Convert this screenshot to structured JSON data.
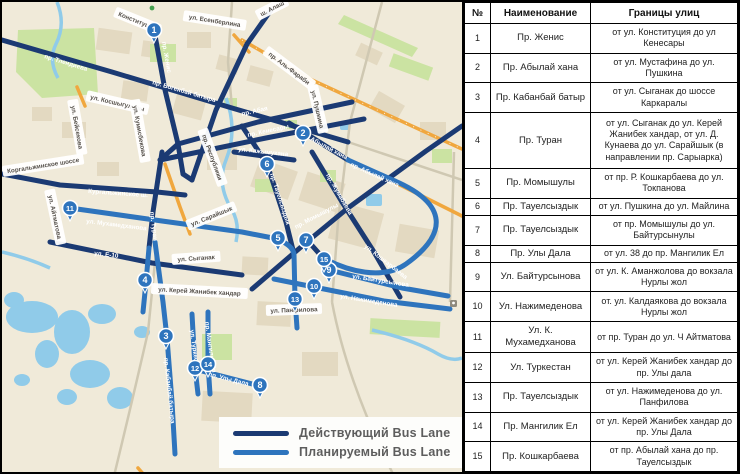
{
  "map": {
    "colors": {
      "existing": "#1b3a73",
      "planned": "#2e74bd",
      "road_orange": "#f0a73e",
      "water": "#90cbe9",
      "green": "#cbe3a2",
      "background": "#f0ead9"
    },
    "legend": {
      "items": [
        {
          "type": "existing",
          "label": "Действующий Bus Lane"
        },
        {
          "type": "planned",
          "label": "Планируемый Bus Lane"
        }
      ]
    },
    "markers": [
      {
        "n": "1",
        "x": 152,
        "y": 28
      },
      {
        "n": "2",
        "x": 301,
        "y": 131
      },
      {
        "n": "3",
        "x": 164,
        "y": 334
      },
      {
        "n": "4",
        "x": 143,
        "y": 278
      },
      {
        "n": "5",
        "x": 276,
        "y": 236
      },
      {
        "n": "6",
        "x": 265,
        "y": 162
      },
      {
        "n": "7",
        "x": 304,
        "y": 238
      },
      {
        "n": "8",
        "x": 258,
        "y": 383
      },
      {
        "n": "9",
        "x": 327,
        "y": 268
      },
      {
        "n": "10",
        "x": 312,
        "y": 284
      },
      {
        "n": "11",
        "x": 68,
        "y": 206
      },
      {
        "n": "12",
        "x": 193,
        "y": 366
      },
      {
        "n": "13",
        "x": 293,
        "y": 297
      },
      {
        "n": "14",
        "x": 206,
        "y": 362
      },
      {
        "n": "15",
        "x": 322,
        "y": 257
      }
    ],
    "line_labels": [
      {
        "t": "пр. Тлендиева",
        "x": 42,
        "y": 56,
        "r": 17
      },
      {
        "t": "пр. Женис",
        "x": 160,
        "y": 40,
        "r": 80
      },
      {
        "t": "пр. Богенбай батыра",
        "x": 150,
        "y": 82,
        "r": 16
      },
      {
        "t": "пр. Абая",
        "x": 240,
        "y": 114,
        "r": -13
      },
      {
        "t": "пр. Кенесары",
        "x": 246,
        "y": 135,
        "r": -12
      },
      {
        "t": "пр. Абылай хана",
        "x": 298,
        "y": 133,
        "r": 28
      },
      {
        "t": "ул. Кажымукана",
        "x": 236,
        "y": 149,
        "r": 6
      },
      {
        "t": "пр. Тауелсыздык",
        "x": 268,
        "y": 172,
        "r": 72
      },
      {
        "t": "пр. Жумабаева",
        "x": 324,
        "y": 173,
        "r": 60
      },
      {
        "t": "пр. Момышулы",
        "x": 294,
        "y": 227,
        "r": -28
      },
      {
        "t": "Кургальжинское ш.",
        "x": 86,
        "y": 191,
        "r": 4
      },
      {
        "t": "ул. Мухамедханова",
        "x": 84,
        "y": 221,
        "r": 7
      },
      {
        "t": "пр. Туран",
        "x": 148,
        "y": 210,
        "r": 83
      },
      {
        "t": "ул. Е-10",
        "x": 92,
        "y": 253,
        "r": 7
      },
      {
        "t": "пр. Абылай хана",
        "x": 348,
        "y": 164,
        "r": 24
      },
      {
        "t": "ул. Кошкарбаева",
        "x": 362,
        "y": 245,
        "r": 38
      },
      {
        "t": "ул. Байтурсынова",
        "x": 350,
        "y": 276,
        "r": 9
      },
      {
        "t": "ул. Нажимеденова",
        "x": 338,
        "y": 296,
        "r": 9
      },
      {
        "t": "пр. Улы Дала",
        "x": 206,
        "y": 374,
        "r": 14
      },
      {
        "t": "ул. Туркестан",
        "x": 188,
        "y": 328,
        "r": 82
      },
      {
        "t": "пр. Мангилик Ел",
        "x": 203,
        "y": 320,
        "r": 82
      },
      {
        "t": "пр. Кабанбай батыра",
        "x": 162,
        "y": 356,
        "r": 84
      }
    ],
    "chip_labels": [
      {
        "t": "Конституции",
        "x": 112,
        "y": 12,
        "r": 22
      },
      {
        "t": "ул. Есенберлина",
        "x": 181,
        "y": 16,
        "r": 9
      },
      {
        "t": "ш. Алаш",
        "x": 256,
        "y": 16,
        "r": -27
      },
      {
        "t": "пр. Аль-Фараби",
        "x": 262,
        "y": 50,
        "r": 37
      },
      {
        "t": "ул. Пушкина",
        "x": 308,
        "y": 84,
        "r": 77
      },
      {
        "t": "ул. Бейсекова",
        "x": 68,
        "y": 98,
        "r": 80
      },
      {
        "t": "ул. Косшыгулулы",
        "x": 84,
        "y": 96,
        "r": 13
      },
      {
        "t": "ул. Кумисбекова",
        "x": 130,
        "y": 98,
        "r": 80
      },
      {
        "t": "пр. Республики",
        "x": 198,
        "y": 128,
        "r": 70
      },
      {
        "t": "Коргальжинское шоссе",
        "x": 1,
        "y": 172,
        "r": -9
      },
      {
        "t": "ул. Айтматова",
        "x": 45,
        "y": 188,
        "r": 78
      },
      {
        "t": "ул. Сарайшык",
        "x": 186,
        "y": 226,
        "r": -22
      },
      {
        "t": "ул. Сыганак",
        "x": 170,
        "y": 260,
        "r": -4
      },
      {
        "t": "ул. Керей Жанибек хандар",
        "x": 149,
        "y": 289,
        "r": 3
      },
      {
        "t": "ул. Панфилова",
        "x": 264,
        "y": 311,
        "r": -2
      }
    ],
    "station_icon": "railway-station-icon"
  },
  "table": {
    "headers": [
      "№",
      "Наименование",
      "Границы улиц"
    ],
    "rows": [
      {
        "num": "1",
        "name": "Пр. Женис",
        "bounds": "от ул. Конституция до ул Кенесары"
      },
      {
        "num": "2",
        "name": "Пр. Абылай хана",
        "bounds": "от ул. Мустафина до ул. Пушкина"
      },
      {
        "num": "3",
        "name": "Пр. Кабанбай батыр",
        "bounds": "от ул. Сыганак до шоссе Каркаралы"
      },
      {
        "num": "4",
        "name": "Пр. Туран",
        "bounds": "от ул. Сыганак до ул. Керей Жанибек хандар, от ул. Д. Кунаева до ул. Сарайшык (в направлении пр. Сарыарка)"
      },
      {
        "num": "5",
        "name": "Пр. Момышулы",
        "bounds": "от пр. Р. Кошкарбаева до ул. Токпанова"
      },
      {
        "num": "6",
        "name": "Пр. Тауелсыздык",
        "bounds": "от ул. Пушкина до ул. Майлина"
      },
      {
        "num": "7",
        "name": "Пр. Тауелсыздык",
        "bounds": "от пр. Момышулы до ул. Байтурсынулы"
      },
      {
        "num": "8",
        "name": "Пр. Улы Дала",
        "bounds": "от ул. 38 до пр. Мангилик Ел"
      },
      {
        "num": "9",
        "name": "Ул. Байтурсынова",
        "bounds": "от ул. К. Аманжолова до вокзала Нурлы жол"
      },
      {
        "num": "10",
        "name": "Ул. Нажимеденова",
        "bounds": "от. ул. Калдаякова до вокзала Нурлы жол"
      },
      {
        "num": "11",
        "name": "Ул. К. Мухамедханова",
        "bounds": "от пр. Туран до ул. Ч Айтматова"
      },
      {
        "num": "12",
        "name": "Ул. Туркестан",
        "bounds": "от ул. Керей Жанибек хандар до пр. Улы дала"
      },
      {
        "num": "13",
        "name": "Пр. Тауелсыздык",
        "bounds": "от ул. Нажимеденова до ул. Панфилова"
      },
      {
        "num": "14",
        "name": "Пр. Мангилик Ел",
        "bounds": "от ул. Керей Жанибек хандар до пр. Улы Дала"
      },
      {
        "num": "15",
        "name": "Пр. Кошкарбаева",
        "bounds": "от пр. Абылай хана до пр. Тауелсыздык"
      }
    ]
  }
}
